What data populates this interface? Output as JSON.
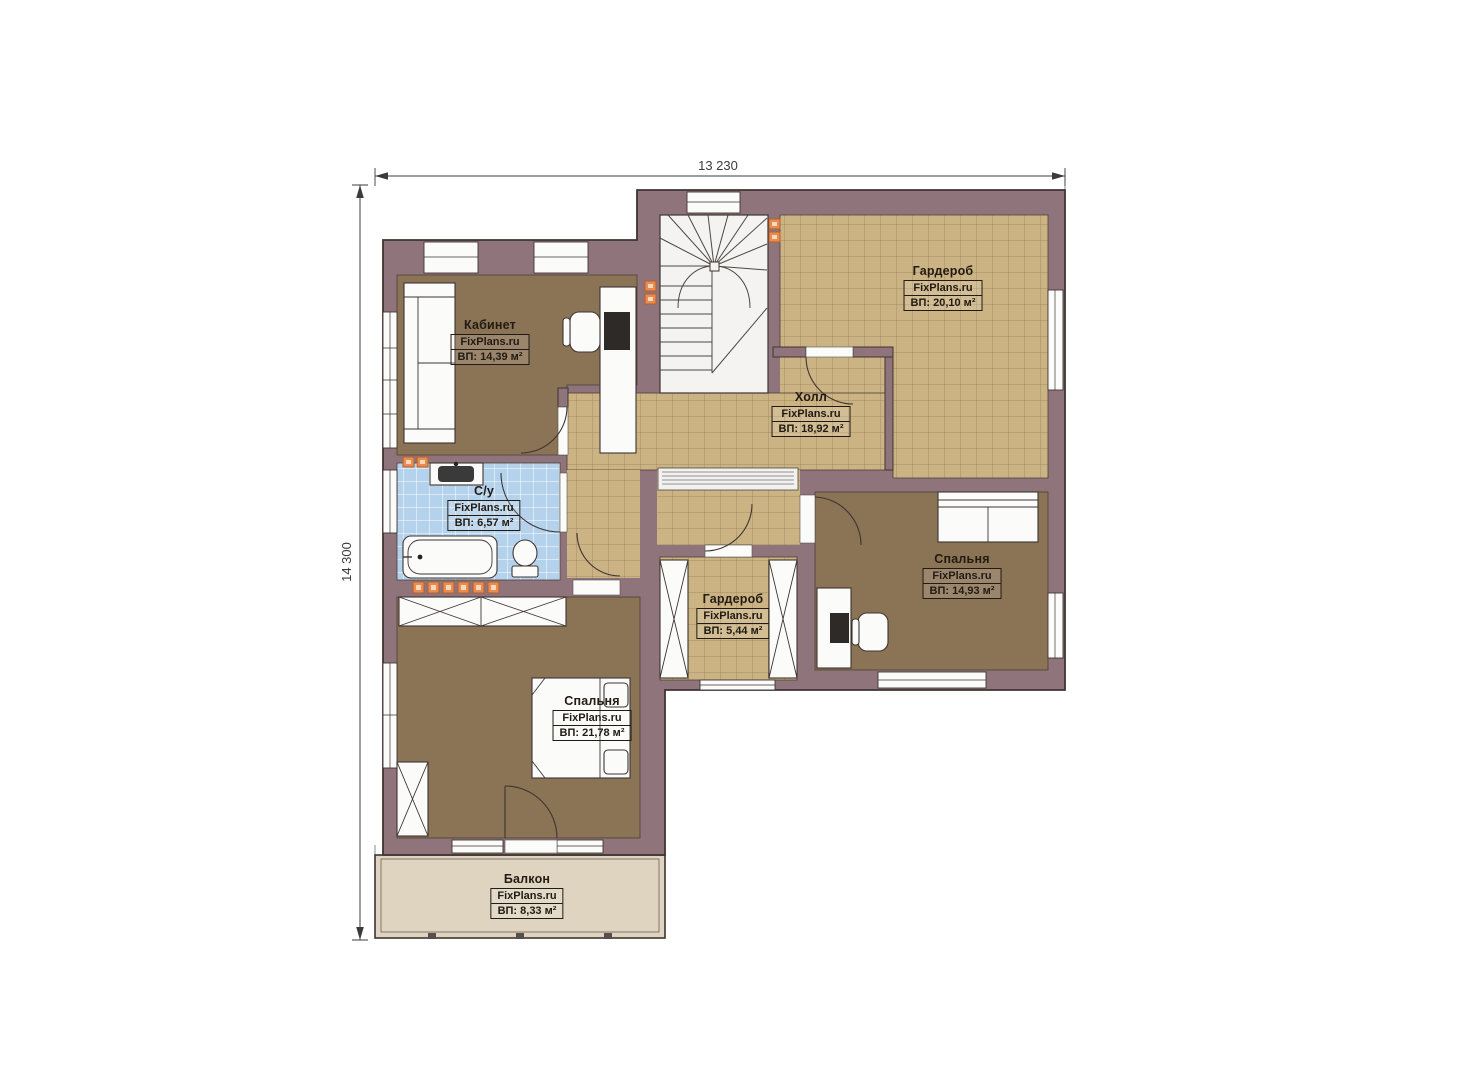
{
  "watermark": "FixPlans.ru",
  "dimensions": {
    "width_label": "13 230",
    "height_label": "14 300"
  },
  "rooms": [
    {
      "id": "kabinet",
      "name": "Кабинет",
      "area": "ВП: 14,39 м²"
    },
    {
      "id": "garderob-top",
      "name": "Гардероб",
      "area": "ВП: 20,10 м²"
    },
    {
      "id": "holl",
      "name": "Холл",
      "area": "ВП: 18,92 м²"
    },
    {
      "id": "su",
      "name": "С/у",
      "area": "ВП: 6,57 м²"
    },
    {
      "id": "garderob-mid",
      "name": "Гардероб",
      "area": "ВП: 5,44 м²"
    },
    {
      "id": "spalnya-right",
      "name": "Спальня",
      "area": "ВП: 14,93 м²"
    },
    {
      "id": "spalnya-bottom",
      "name": "Спальня",
      "area": "ВП: 21,78 м²"
    },
    {
      "id": "balkon",
      "name": "Балкон",
      "area": "ВП: 8,33 м²"
    }
  ],
  "colors": {
    "wall": "#8f747c",
    "outline": "#3e3531",
    "floor_wood": "#8b7355",
    "floor_tile": "#cbb384",
    "floor_bath": "#b5d2ec",
    "floor_balcony": "#ded4c0",
    "accent_orange": "#ea8c50",
    "dimension": "#3b3b3b"
  }
}
